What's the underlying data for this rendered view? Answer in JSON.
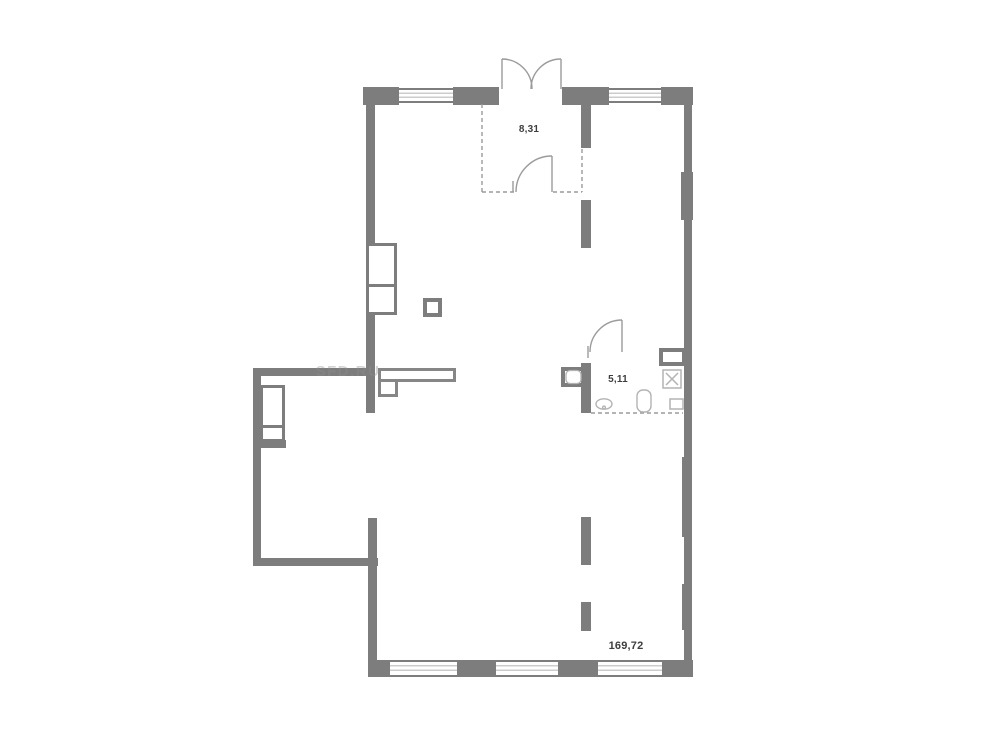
{
  "page": {
    "background_color": "#ffffff"
  },
  "plan": {
    "kind": "apartment-floor-plan",
    "watermark": "SFD.RU",
    "rooms": [
      {
        "name": "entry-vestibule",
        "area": "8,31"
      },
      {
        "name": "bathroom",
        "area": "5,11"
      },
      {
        "name": "main-open-space",
        "area": "169,72"
      }
    ],
    "colors": {
      "wall": "#7d7d7d",
      "fixture_outline": "#b3b3b3",
      "dashed_line": "#9b9b9b",
      "label_text": "#3e3e3e",
      "watermark_text": "#8f8f8f"
    }
  }
}
